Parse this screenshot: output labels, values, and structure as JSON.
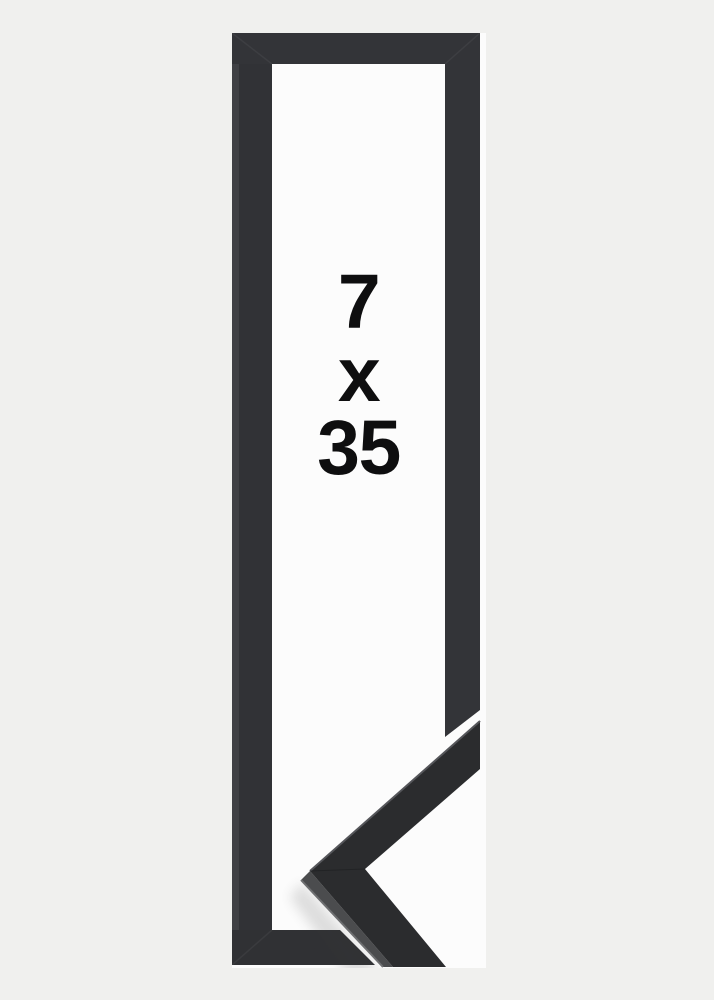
{
  "page": {
    "background_color": "#f0f0ee",
    "title": "Picture frame product image"
  },
  "product_image": {
    "size_label": {
      "full_text": "7 x 35",
      "lines": [
        "7",
        "x",
        "35"
      ]
    },
    "colors": {
      "frame_face": "#313236",
      "frame_bevel_highlight": "#3f4044",
      "photo_background": "#fcfcfc",
      "corner_sample_face": "#2b2c2e",
      "corner_sample_side": "#4b4c4e",
      "corner_sample_edge_highlight": "#6e6f71",
      "label_text": "#0e0e0f"
    },
    "elements": {
      "frame": "black-frame-elevation",
      "corner_sample": "mitered-corner-moulding-sample"
    }
  }
}
